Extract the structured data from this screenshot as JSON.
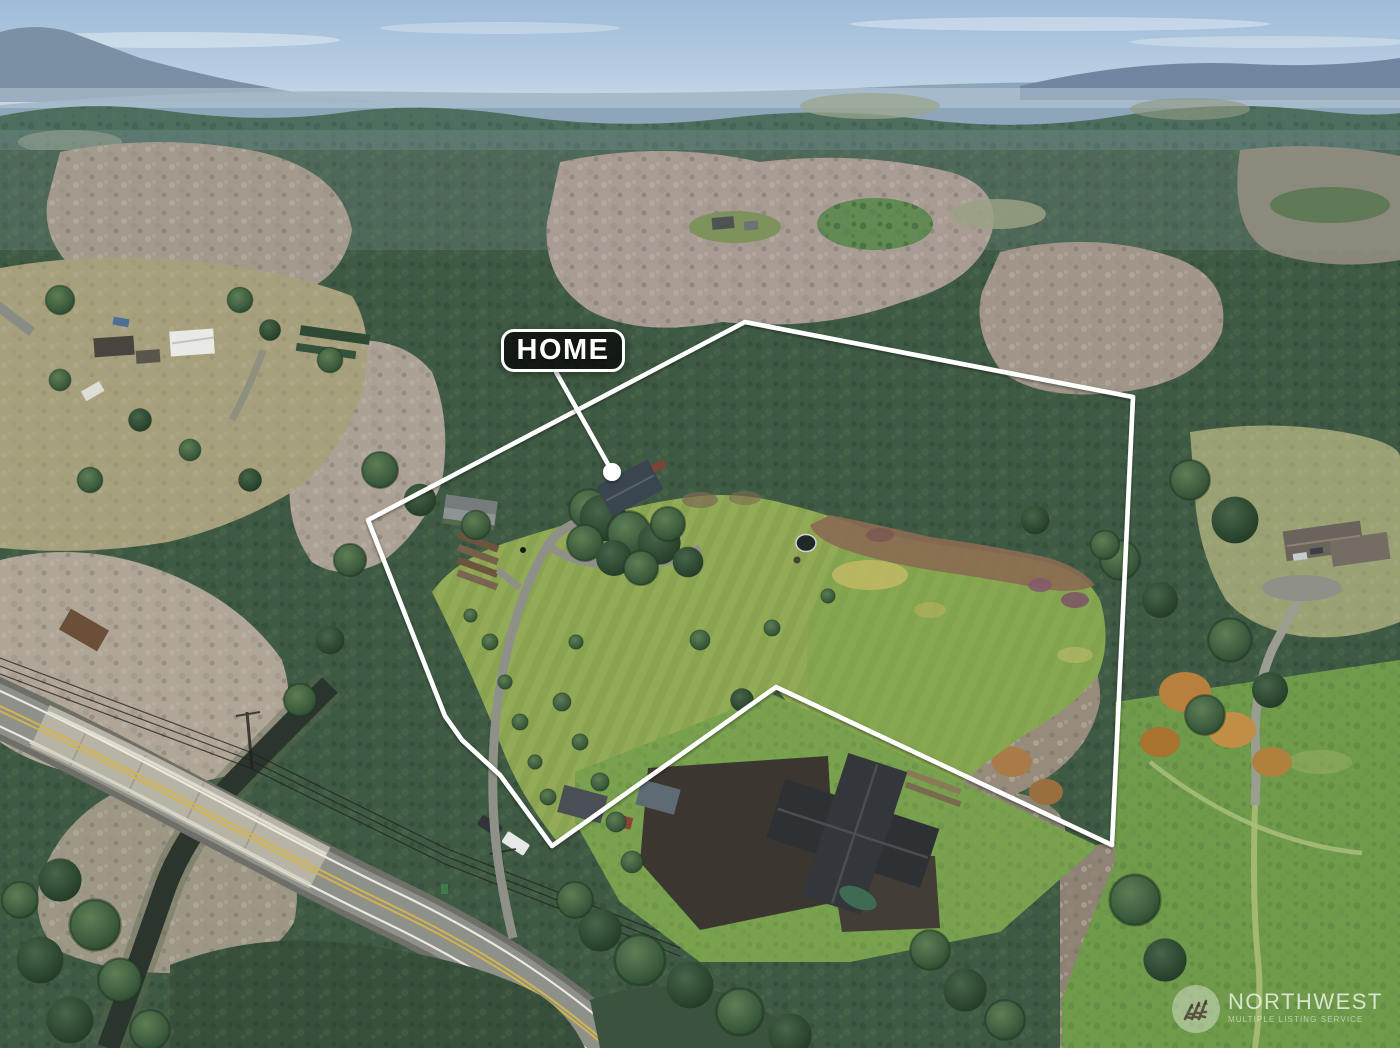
{
  "home_callout": {
    "label": "HOME"
  },
  "watermark": {
    "brand": "NORTHWEST",
    "tagline": "MULTIPLE LISTING SERVICE",
    "logo": "pine-trees-icon"
  },
  "colors": {
    "boundary_line": "#ffffff",
    "callout_bg": "#0d100b",
    "callout_border": "#ffffff",
    "callout_text": "#ffffff",
    "marker_dot": "#ffffff",
    "sky_top": "#9dbbd9",
    "sky_horizon": "#d3deea",
    "distant_ridge": "#87a0b5",
    "forest_dark": "#3f5a44",
    "bare_trees": "#a89c90",
    "meadow_green": "#8aa350",
    "field_green": "#6f9b4a",
    "road_asphalt": "#8e908a",
    "bridge_deck": "#b7b4a6",
    "creek": "#2a352e",
    "autumn_orange": "#b8813e",
    "roof_dark": "#2e3134"
  }
}
